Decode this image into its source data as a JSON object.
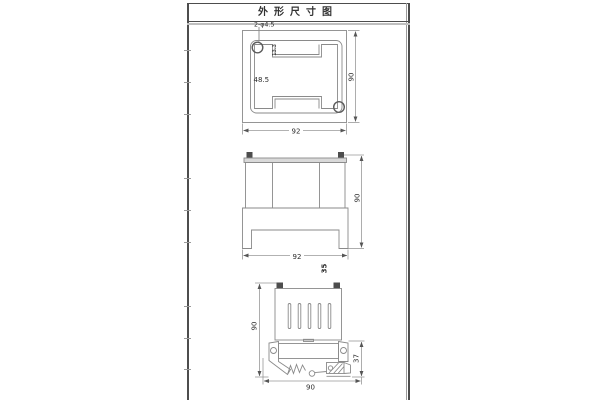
{
  "frame": {
    "title": "外形尺寸图"
  },
  "colors": {
    "frame_border": "#4d4d4d",
    "separator_gray": "#bfbfbf",
    "drawing_line": "#8a8a8a",
    "dimension_line": "#999999",
    "dark_fill": "#4d4d4d",
    "light_fill": "#d9d9d9",
    "text": "#2b2b2b"
  },
  "top_view": {
    "hole_callout": "2-φ4.5",
    "slot_depth": "13.3",
    "inner_dim": "48.5",
    "height": "90",
    "width": "92"
  },
  "front_view": {
    "height": "90",
    "width": "92",
    "depth": "35"
  },
  "side_view": {
    "height": "90",
    "clip_height": "37",
    "width": "90"
  }
}
